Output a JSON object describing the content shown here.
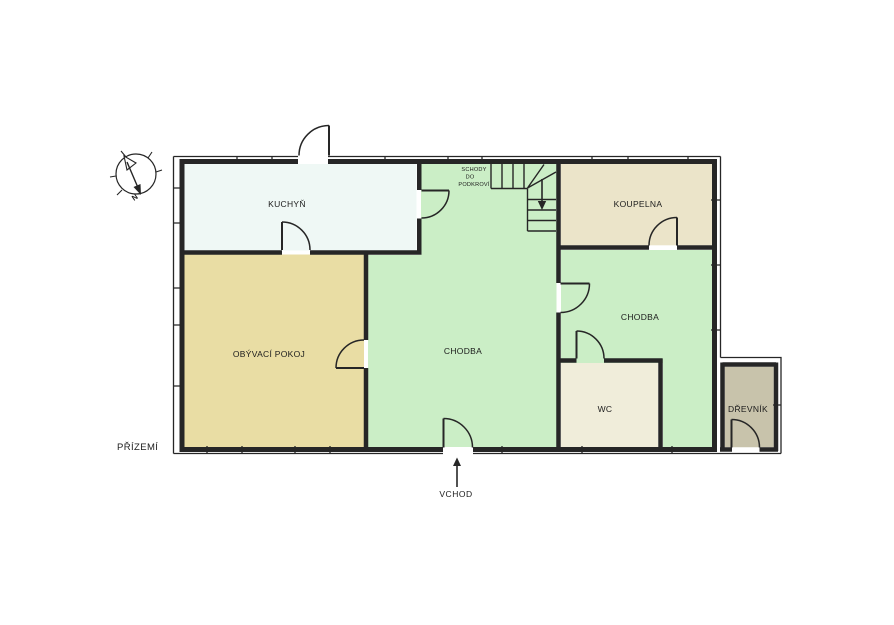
{
  "floor_plan": {
    "floor_label": "PŘÍZEMÍ",
    "entrance_label": "VCHOD",
    "compass": {
      "north_label": "N"
    },
    "stairs_note": {
      "line1": "SCHODY",
      "line2": "DO",
      "line3": "PODKROVÍ"
    },
    "rooms": {
      "kitchen": {
        "label": "KUCHYŇ",
        "color": "#eff8f5"
      },
      "living_room": {
        "label": "OBÝVACÍ POKOJ",
        "color": "#e9dda4"
      },
      "hall_main": {
        "label": "CHODBA",
        "color": "#cbeec6"
      },
      "bathroom": {
        "label": "KOUPELNA",
        "color": "#ebe4c9"
      },
      "hall_back": {
        "label": "CHODBA",
        "color": "#cbeec6"
      },
      "wc": {
        "label": "WC",
        "color": "#f0edda"
      },
      "woodshed": {
        "label": "DŘEVNÍK",
        "color": "#c8c3ab"
      }
    },
    "colors": {
      "wall": "#262626",
      "background": "#ffffff"
    }
  }
}
